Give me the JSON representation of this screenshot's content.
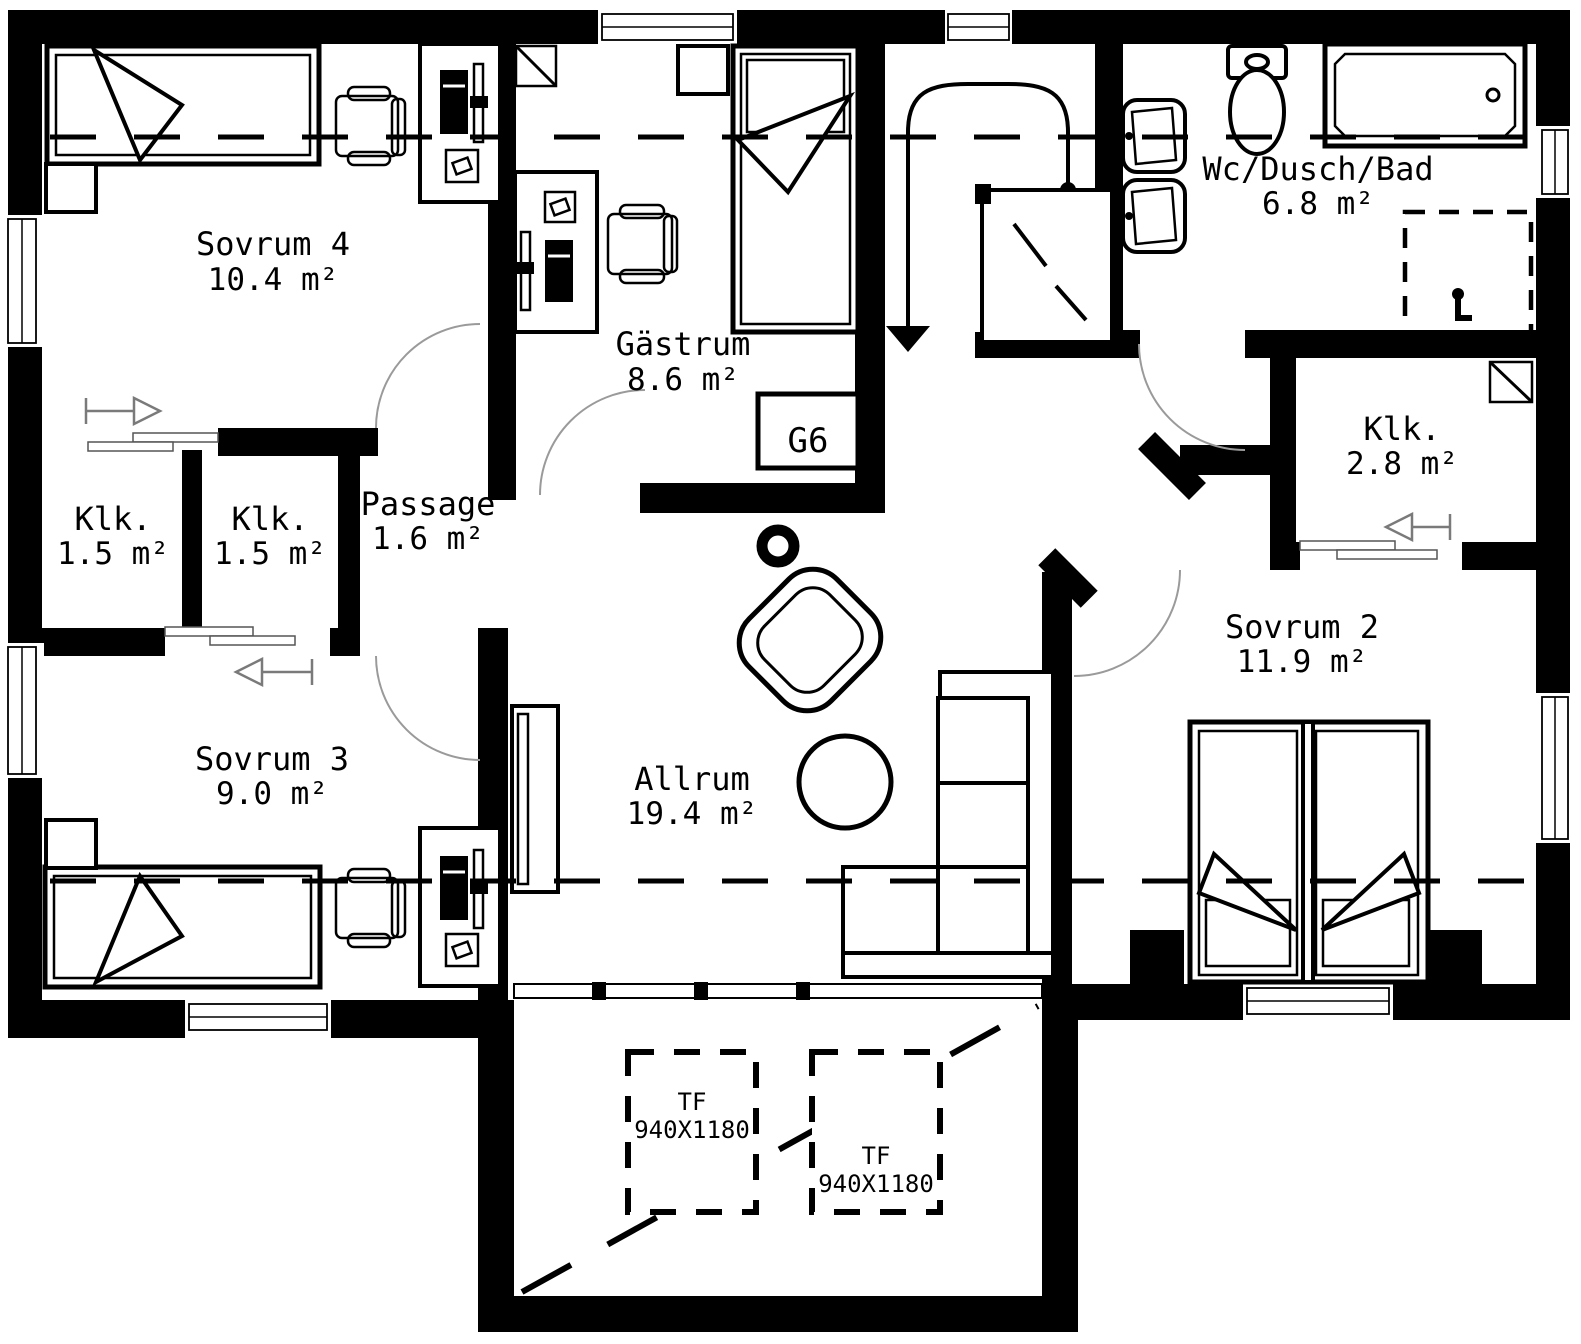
{
  "rooms": {
    "sovrum4": {
      "name": "Sovrum 4",
      "area": "10.4 m²"
    },
    "gastrum": {
      "name": "Gästrum",
      "area": "8.6 m²"
    },
    "wc": {
      "name": "Wc/Dusch/Bad",
      "area": "6.8 m²"
    },
    "klk_hall": {
      "name": "Klk.",
      "area": "2.8 m²"
    },
    "klk_a": {
      "name": "Klk.",
      "area": "1.5 m²"
    },
    "klk_b": {
      "name": "Klk.",
      "area": "1.5 m²"
    },
    "passage": {
      "name": "Passage",
      "area": "1.6 m²"
    },
    "sovrum3": {
      "name": "Sovrum 3",
      "area": "9.0 m²"
    },
    "allrum": {
      "name": "Allrum",
      "area": "19.4 m²"
    },
    "sovrum2": {
      "name": "Sovrum 2",
      "area": "11.9 m²"
    }
  },
  "annotations": {
    "wardrobe_label": "G6",
    "skylight_1": {
      "code": "TF",
      "size": "940X1180"
    },
    "skylight_2": {
      "code": "TF",
      "size": "940X1180"
    }
  },
  "colors": {
    "wall": "#000000",
    "background": "#ffffff",
    "door_arc": "#9a9a9a"
  }
}
